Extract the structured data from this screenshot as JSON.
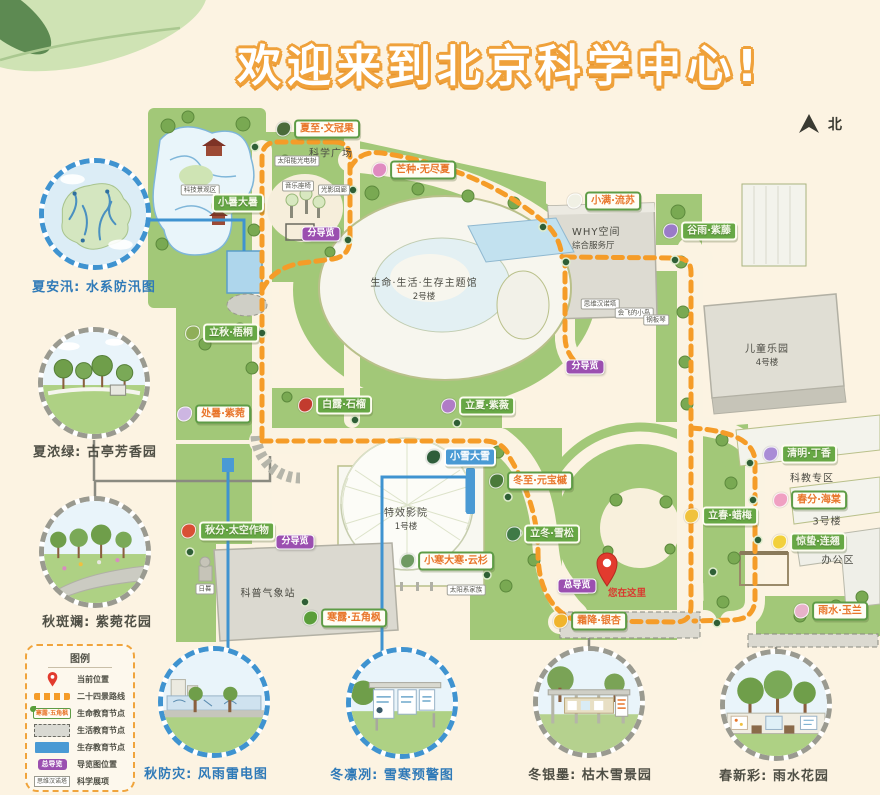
{
  "title": "欢迎来到北京科学中心!",
  "compass": {
    "label": "北"
  },
  "vignettes": [
    {
      "caption": "夏安汛: 水系防汛图",
      "type": "blue",
      "scene": "flood-map"
    },
    {
      "caption": "夏浓绿: 古亭芳香园",
      "type": "gray",
      "scene": "ancient-pavilion-garden"
    },
    {
      "caption": "秋斑斓: 紫菀花园",
      "type": "gray",
      "scene": "aster-garden"
    },
    {
      "caption": "秋防灾: 风雨雷电图",
      "type": "blue",
      "scene": "storm-wall"
    },
    {
      "caption": "冬凛冽: 雪寒预警图",
      "type": "blue",
      "scene": "snow-warning-boards"
    },
    {
      "caption": "冬银墨: 枯木雪景园",
      "type": "gray",
      "scene": "withered-wood-snow-garden"
    },
    {
      "caption": "春新彩: 雨水花园",
      "type": "gray",
      "scene": "rain-garden"
    }
  ],
  "legend": {
    "title": "图例",
    "items": [
      {
        "icon": "location-pin-icon",
        "label": "当前位置"
      },
      {
        "icon": "route-dash-icon",
        "label": "二十四景路线"
      },
      {
        "icon": "life-node-sample",
        "sample": "寒露·五角枫",
        "label": "生命教育节点"
      },
      {
        "icon": "living-node-sample",
        "label": "生活教育节点"
      },
      {
        "icon": "survival-node-sample",
        "label": "生存教育节点"
      },
      {
        "icon": "guide-pill-sample",
        "sample": "总导览",
        "label": "导览图位置"
      },
      {
        "icon": "exhibit-box-sample",
        "sample": "思维汉诺塔",
        "label": "科学展项"
      }
    ]
  },
  "map": {
    "areas": [
      {
        "text": "生命·生活·生存主题馆",
        "sub": "2号楼",
        "x": 424,
        "y": 288
      },
      {
        "text": "WHY空间",
        "sub": "综合服务厅",
        "x": 572,
        "y": 237,
        "align": "left"
      },
      {
        "text": "儿童乐园",
        "sub": "4号楼",
        "x": 767,
        "y": 354
      },
      {
        "text": "特效影院",
        "sub": "1号楼",
        "x": 406,
        "y": 518
      },
      {
        "text": "科普气象站",
        "x": 268,
        "y": 592
      },
      {
        "text": "科学广场",
        "x": 331,
        "y": 152
      },
      {
        "text": "科教专区",
        "x": 812,
        "y": 477
      },
      {
        "text": "3号楼",
        "x": 827,
        "y": 520
      },
      {
        "text": "办公区",
        "x": 838,
        "y": 559
      }
    ],
    "nodes": [
      {
        "text": "夏至·文冠果",
        "style": "white",
        "icon": "yellowhorn-bird-icon",
        "color": "#4a6b3a",
        "x": 318,
        "y": 129
      },
      {
        "text": "芒种·无尽夏",
        "style": "white",
        "icon": "hydrangea-icon",
        "color": "#e08bc0",
        "x": 414,
        "y": 170
      },
      {
        "text": "小暑大暑",
        "style": "green",
        "icon": null,
        "color": null,
        "x": 238,
        "y": 203
      },
      {
        "text": "小满·流苏",
        "style": "white",
        "icon": "fringe-tree-icon",
        "color": "#f0f0e4",
        "x": 604,
        "y": 201
      },
      {
        "text": "谷雨·紫藤",
        "style": "green",
        "icon": "wisteria-icon",
        "color": "#9a7bc8",
        "x": 700,
        "y": 231
      },
      {
        "text": "立秋·梧桐",
        "style": "green",
        "icon": "parasol-leaf-icon",
        "color": "#8fae58",
        "x": 222,
        "y": 333
      },
      {
        "text": "处暑·紫菀",
        "style": "white",
        "icon": "aster-icon",
        "color": "#cdb6e2",
        "x": 214,
        "y": 414
      },
      {
        "text": "白露·石榴",
        "style": "green",
        "icon": "pomegranate-icon",
        "color": "#c23b2e",
        "x": 335,
        "y": 405
      },
      {
        "text": "立夏·紫薇",
        "style": "green",
        "icon": "crape-myrtle-icon",
        "color": "#b07cc6",
        "x": 478,
        "y": 406
      },
      {
        "text": "秋分·太空作物",
        "style": "green",
        "icon": "space-crops-icon",
        "color": "#d94f35",
        "x": 228,
        "y": 531
      },
      {
        "text": "寒露·五角枫",
        "style": "white",
        "icon": "maple-leaf-icon",
        "color": "#5a9e3a",
        "x": 345,
        "y": 618
      },
      {
        "text": "小雪大雪",
        "style": "blue",
        "icon": "dark-leaf-icon",
        "color": "#2f5d3a",
        "x": 461,
        "y": 457
      },
      {
        "text": "冬至·元宝槭",
        "style": "white",
        "icon": "maple-seed-icon",
        "color": "#4a7a3a",
        "x": 531,
        "y": 481
      },
      {
        "text": "立冬·雪松",
        "style": "green",
        "icon": "cedar-icon",
        "color": "#3f7a46",
        "x": 543,
        "y": 534
      },
      {
        "text": "小寒大寒·云杉",
        "style": "white",
        "icon": "spruce-icon",
        "color": "#6f9a62",
        "x": 447,
        "y": 561
      },
      {
        "text": "霜降·银杏",
        "style": "white",
        "icon": "ginkgo-icon",
        "color": "#f0b42c",
        "x": 590,
        "y": 621
      },
      {
        "text": "立春·蜡梅",
        "style": "green",
        "icon": "wintersweet-icon",
        "color": "#f0c23c",
        "x": 721,
        "y": 516
      },
      {
        "text": "清明·丁香",
        "style": "green",
        "icon": "lilac-icon",
        "color": "#a98cd6",
        "x": 800,
        "y": 454
      },
      {
        "text": "春分·海棠",
        "style": "white",
        "icon": "crabapple-icon",
        "color": "#f0a0c2",
        "x": 810,
        "y": 500
      },
      {
        "text": "惊蛰·连翘",
        "style": "green",
        "icon": "forsythia-icon",
        "color": "#f2d03c",
        "x": 809,
        "y": 542
      },
      {
        "text": "雨水·玉兰",
        "style": "white",
        "icon": "magnolia-icon",
        "color": "#e8b2ca",
        "x": 831,
        "y": 611
      }
    ],
    "exhibits": [
      {
        "text": "科技景观区",
        "x": 200,
        "y": 190
      },
      {
        "text": "太阳能光电树",
        "x": 297,
        "y": 161
      },
      {
        "text": "音乐座椅",
        "x": 298,
        "y": 186
      },
      {
        "text": "光影回廊",
        "x": 334,
        "y": 190
      },
      {
        "text": "思维汉诺塔",
        "x": 600,
        "y": 304
      },
      {
        "text": "会飞的小鸟",
        "x": 634,
        "y": 313
      },
      {
        "text": "钢板琴",
        "x": 656,
        "y": 320
      },
      {
        "text": "太阳系家族",
        "x": 466,
        "y": 590
      },
      {
        "text": "日晷",
        "x": 205,
        "y": 589
      }
    ],
    "guides": {
      "sub_label": "分导览",
      "sub_positions": [
        {
          "x": 321,
          "y": 234
        },
        {
          "x": 585,
          "y": 367
        },
        {
          "x": 295,
          "y": 542
        }
      ],
      "main_label": "总导览",
      "main_pos": {
        "x": 577,
        "y": 586
      },
      "you_are_here": {
        "text": "您在这里",
        "x": 627,
        "y": 592
      }
    }
  },
  "colors": {
    "route_orange": "#f59c28",
    "survival_blue": "#4a9ad4",
    "guide_purple": "#9b4fb0",
    "node_green": "#67a845",
    "node_text_orange": "#e8762b",
    "title_orange": "#efa13b",
    "lawn_green": "#a2c878",
    "background_cream": "#fcf3e2"
  }
}
